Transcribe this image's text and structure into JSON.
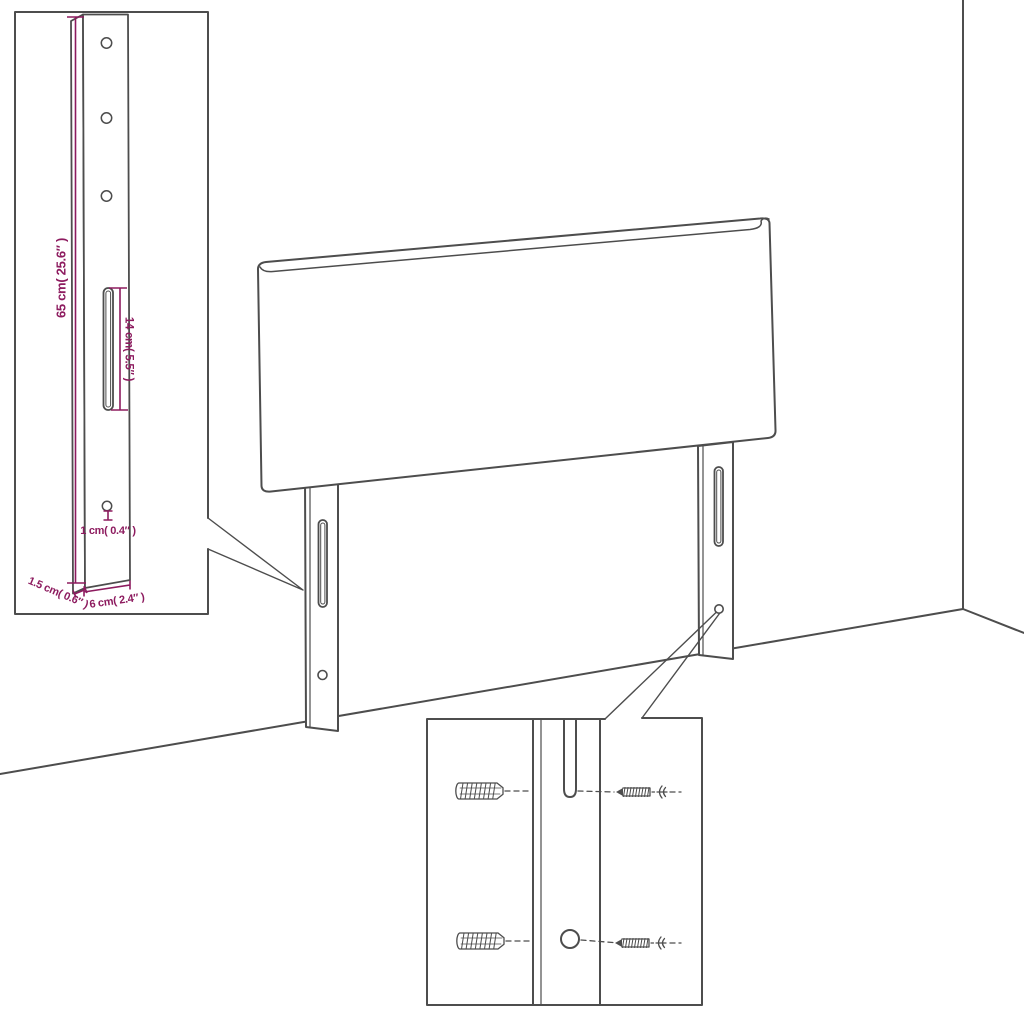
{
  "page": {
    "background_color": "#ffffff",
    "line_color": "#4d4d4d",
    "dimension_color": "#8d1b5f"
  },
  "diagram": {
    "subject": "wall-mounted headboard with bracket legs, dimension detail inset and mounting hardware inset",
    "bracket_inset": {
      "height_label": "65 cm( 25.6″ )",
      "slot_length_label": "14 cm( 5.5″ )",
      "hole_diameter_label": "1 cm( 0.4″ )",
      "thickness_label": "1.5 cm( 0.6″ )",
      "width_label": "6 cm( 2.4″ )"
    },
    "hardware_inset": {
      "wall_plug_count": 2,
      "screw_count": 2
    }
  }
}
